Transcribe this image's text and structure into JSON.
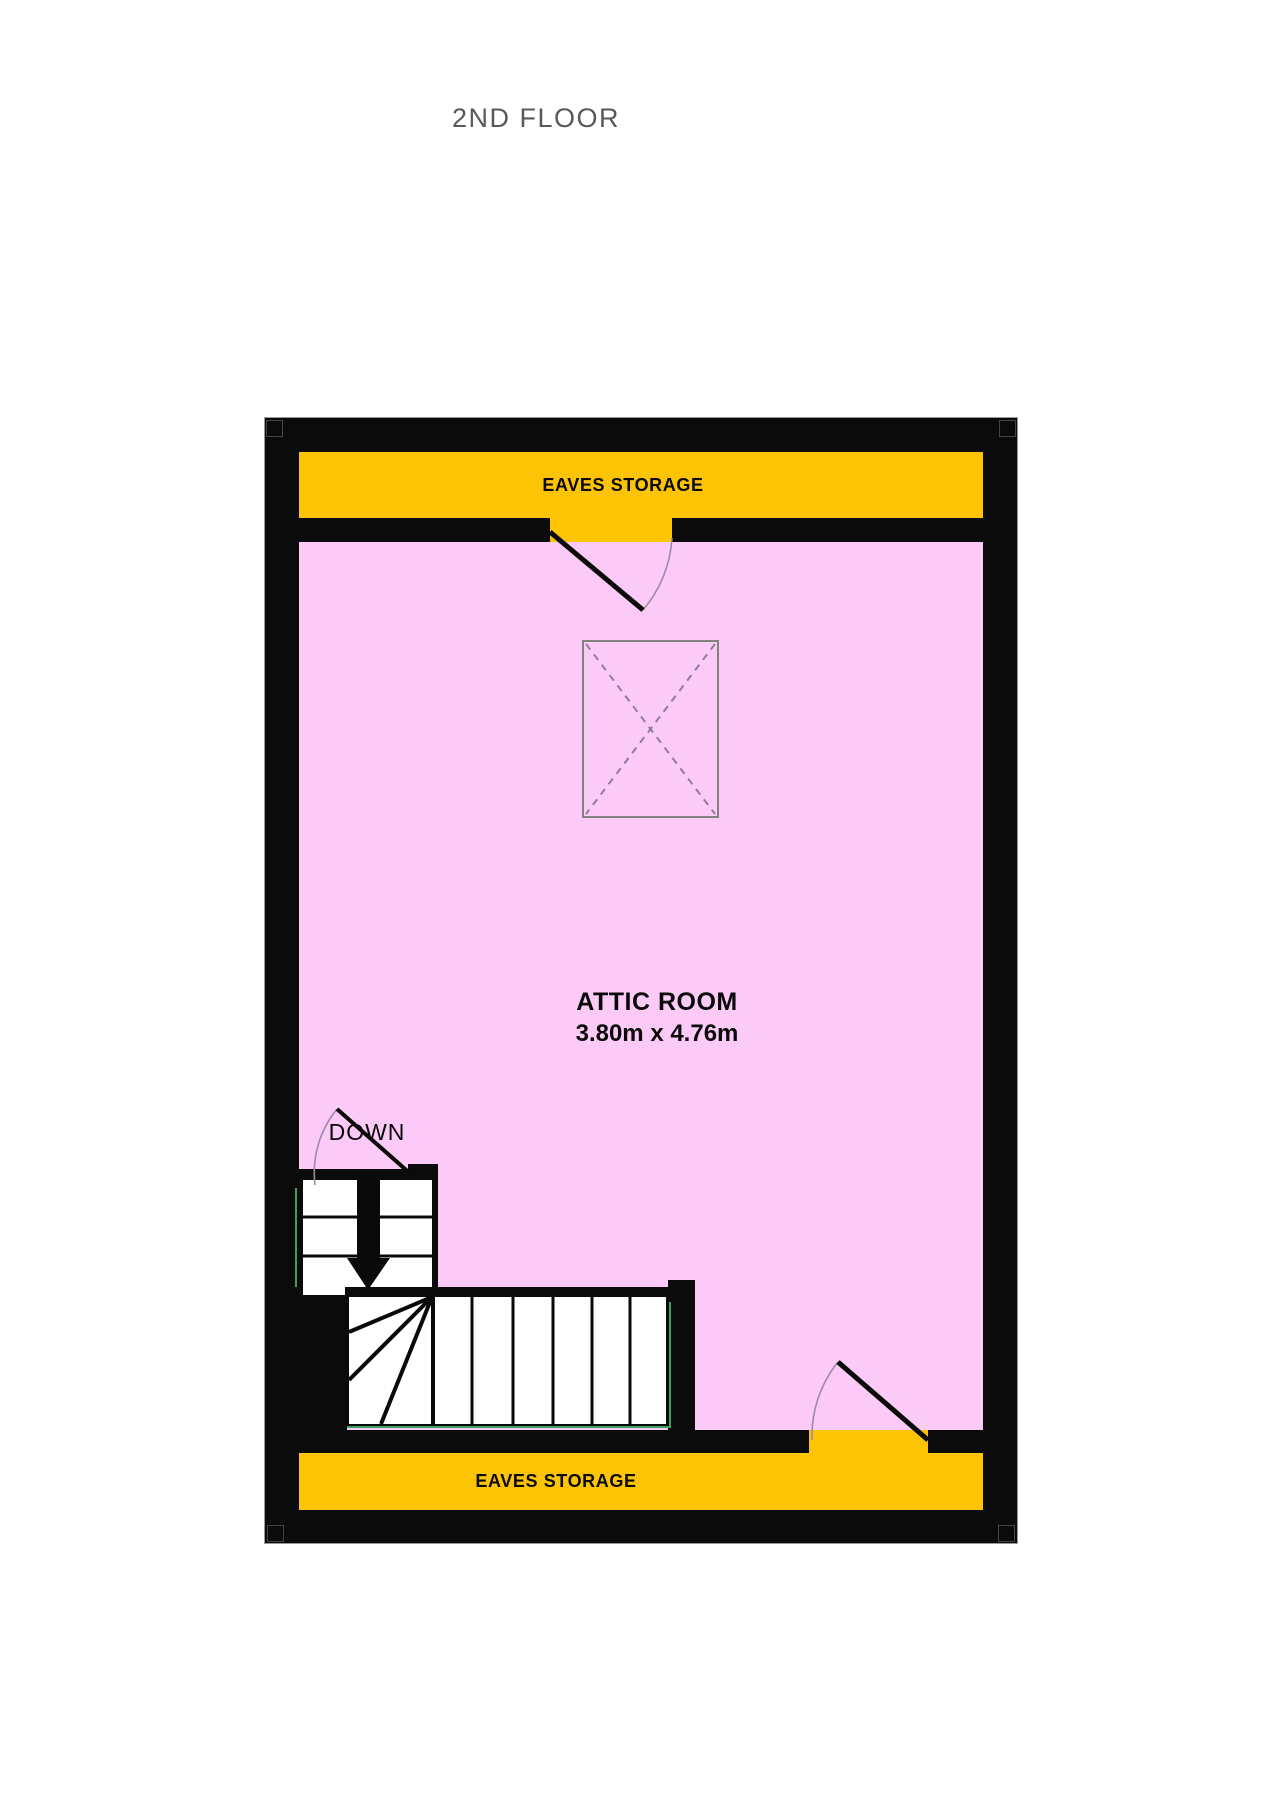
{
  "title": "2ND FLOOR",
  "plan": {
    "room": {
      "name": "ATTIC ROOM",
      "dimensions": "3.80m  x 4.76m"
    },
    "eaves_storage_top": "EAVES STORAGE",
    "eaves_storage_bottom": "EAVES STORAGE",
    "stairs_direction": "DOWN"
  },
  "colors": {
    "wall": "#0b0b0b",
    "floor": "#fccaf6",
    "eaves": "#fcc405",
    "stair_accent_green": "#3f9f5f",
    "door_arc": "#9d8aa2",
    "skylight_outline": "#828282",
    "skylight_dash": "#8f7f94",
    "title_text": "#58595b"
  }
}
